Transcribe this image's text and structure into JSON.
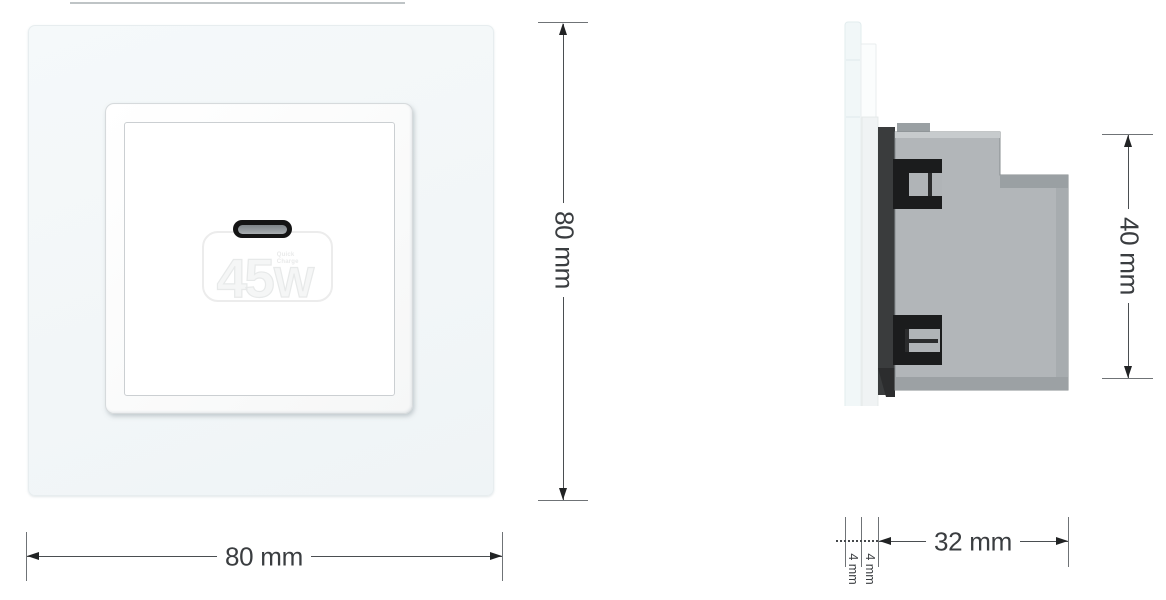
{
  "front_view": {
    "port": {
      "power_number": "45",
      "power_unit": "W",
      "small_text_line1": "Quick",
      "small_text_line2": "Charge"
    },
    "height_dim_label": "80 mm",
    "width_dim_label": "80 mm"
  },
  "side_view": {
    "height_dim_label": "40 mm",
    "depth_dim_label": "32 mm",
    "glass_thickness_label": "4 mm",
    "frame_thickness_label": "4 mm"
  },
  "colors": {
    "glass_tint": "#f2f7f8",
    "mechanism_gray": "#b2b6b9",
    "mechanism_dark": "#3a3c3d",
    "clip_black": "#1b1c1d",
    "dimension_text": "#3a3d40",
    "port_black": "#141414"
  }
}
